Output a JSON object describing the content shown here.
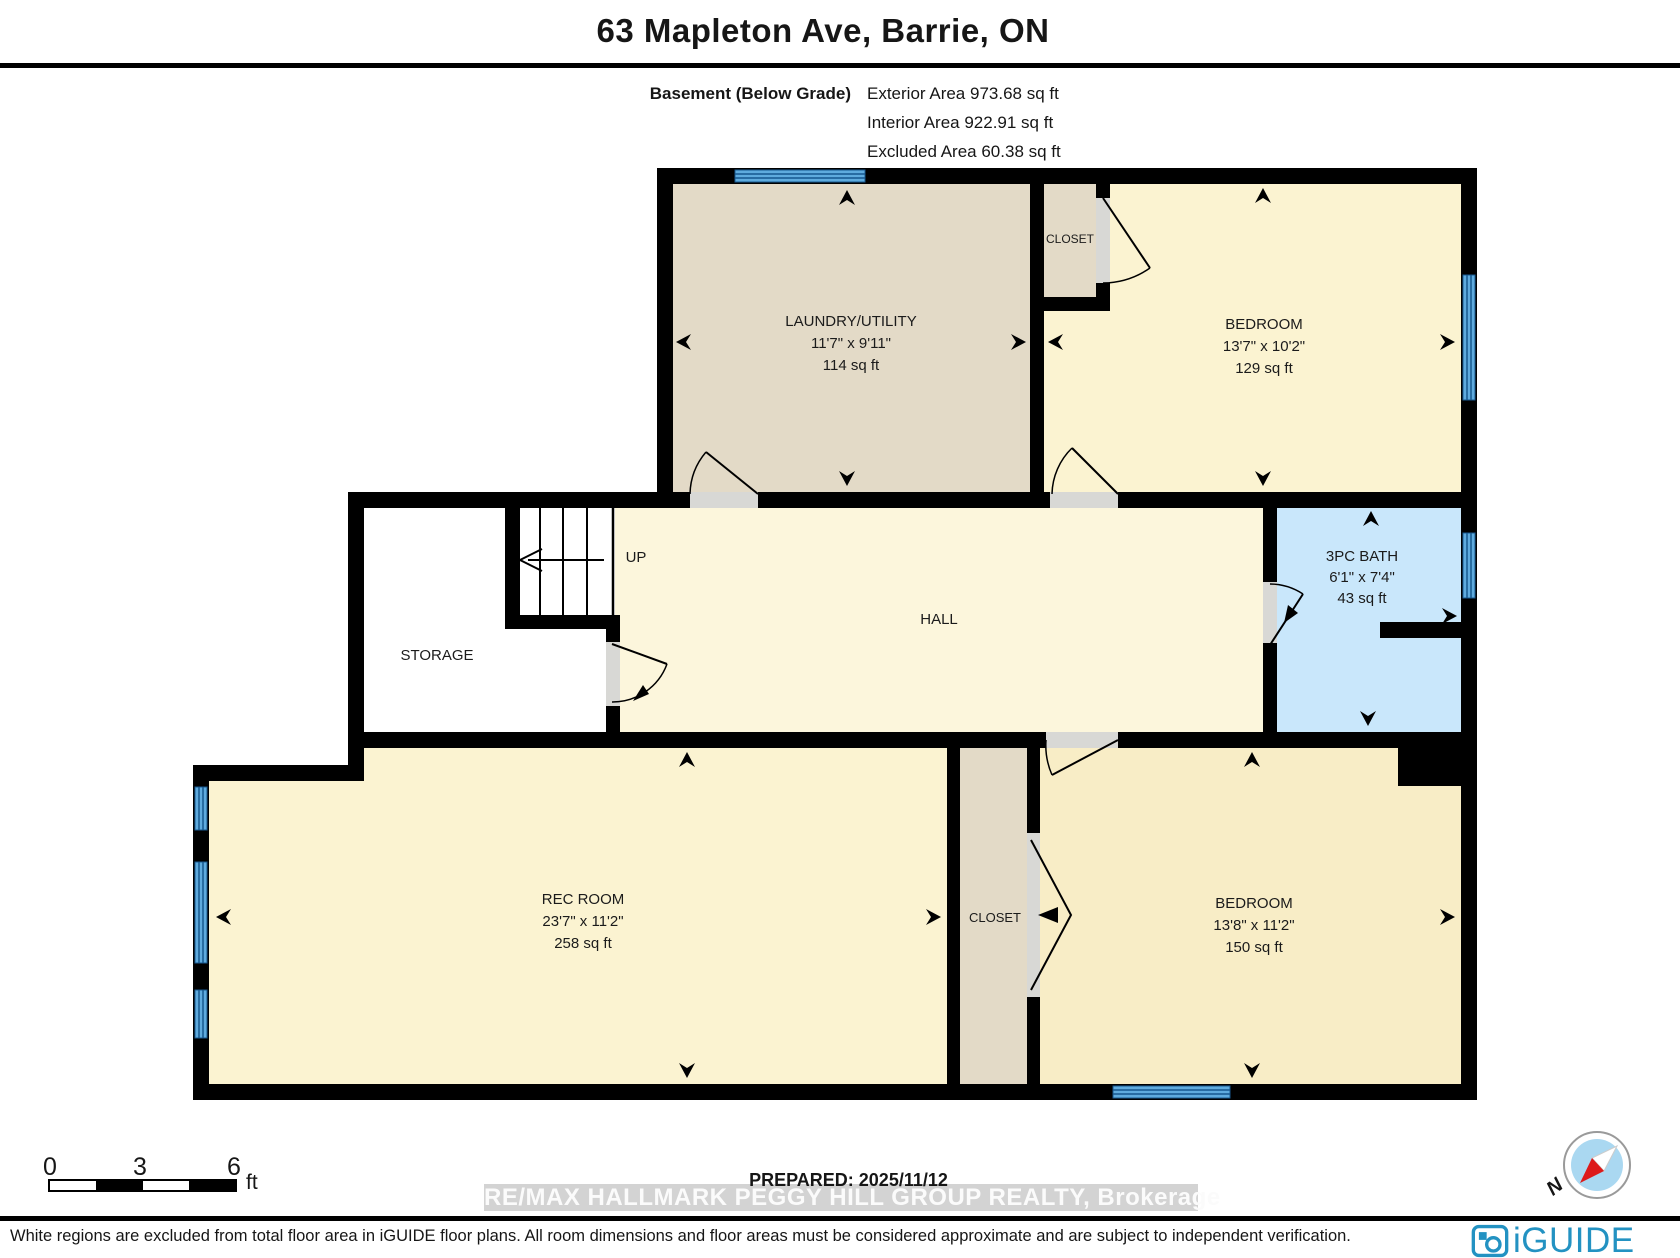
{
  "header": {
    "title": "63 Mapleton Ave, Barrie, ON",
    "floor_label": "Basement (Below Grade)",
    "exterior_area": "Exterior Area 973.68 sq ft",
    "interior_area": "Interior Area 922.91 sq ft",
    "excluded_area": "Excluded Area 60.38 sq ft"
  },
  "rooms": [
    {
      "name": "LAUNDRY/UTILITY",
      "dims": "11'7\" x 9'11\"",
      "area": "114 sq ft"
    },
    {
      "name": "CLOSET"
    },
    {
      "name": "BEDROOM",
      "dims": "13'7\" x 10'2\"",
      "area": "129 sq ft"
    },
    {
      "name": "3PC BATH",
      "dims": "6'1\" x 7'4\"",
      "area": "43 sq ft"
    },
    {
      "name": "HALL"
    },
    {
      "name": "UP"
    },
    {
      "name": "STORAGE"
    },
    {
      "name": "REC ROOM",
      "dims": "23'7\" x 11'2\"",
      "area": "258 sq ft"
    },
    {
      "name": "CLOSET"
    },
    {
      "name": "BEDROOM",
      "dims": "13'8\" x 11'2\"",
      "area": "150 sq ft"
    }
  ],
  "scale_bar": {
    "start": "0",
    "mid": "3",
    "end": "6",
    "unit": "ft"
  },
  "prepared": "PREPARED: 2025/11/12",
  "watermark": "RE/MAX HALLMARK PEGGY HILL GROUP REALTY, Brokerage",
  "compass": {
    "label": "N"
  },
  "footer": {
    "disclaimer": "White regions are excluded from total floor area in iGUIDE floor plans. All room dimensions and floor areas must be considered approximate and are subject to independent verification.",
    "brand": "iGUIDE"
  },
  "colors": {
    "brand_teal": "#2392c2",
    "room_yellow": "#fbf3d1",
    "room_tan": "#e3dac7",
    "bath_blue": "#c9e7fb",
    "window_blue": "#5fabde"
  }
}
